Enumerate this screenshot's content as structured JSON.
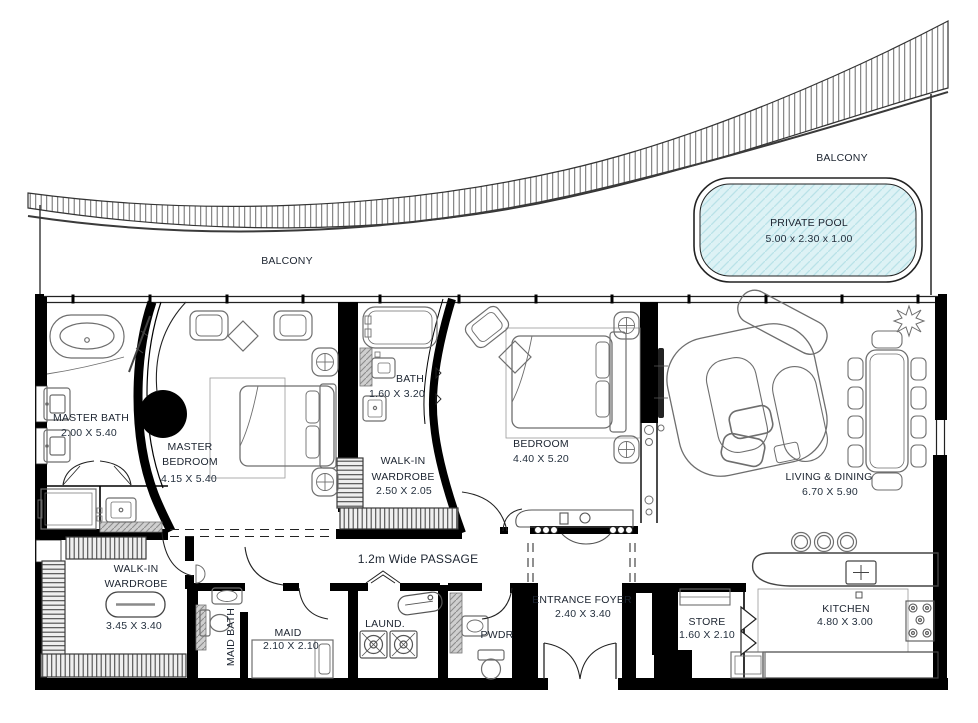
{
  "balcony": {
    "label_left": "BALCONY",
    "label_right": "BALCONY"
  },
  "pool": {
    "name": "PRIVATE POOL",
    "dims": "5.00 x 2.30 x 1.00"
  },
  "rooms": {
    "master_bath": {
      "name": "MASTER BATH",
      "dims": "2.00 X 5.40"
    },
    "master_bedroom": {
      "line1": "MASTER",
      "line2": "BEDROOM",
      "dims": "4.15 X 5.40"
    },
    "bath": {
      "name": "BATH",
      "dims": "1.60 X 3.20"
    },
    "walkin_wardrobe_small": {
      "line1": "WALK-IN",
      "line2": "WARDROBE",
      "dims": "2.50 X 2.05"
    },
    "bedroom": {
      "name": "BEDROOM",
      "dims": "4.40 X 5.20"
    },
    "living_dining": {
      "name": "LIVING & DINING",
      "dims": "6.70 X 5.90"
    },
    "walkin_wardrobe_large": {
      "line1": "WALK-IN",
      "line2": "WARDROBE",
      "dims": "3.45 X 3.40"
    },
    "maid_bath": {
      "name": "MAID BATH"
    },
    "maid": {
      "name": "MAID",
      "dims": "2.10 X 2.10"
    },
    "laundry": {
      "name": "LAUND."
    },
    "powder": {
      "name": "PWDR"
    },
    "passage": {
      "name": "1.2m Wide PASSAGE"
    },
    "entrance_foyer": {
      "name": "ENTRANCE FOYER",
      "dims": "2.40 X 3.40"
    },
    "store": {
      "name": "STORE",
      "dims": "1.60 X 2.10"
    },
    "kitchen": {
      "name": "KITCHEN",
      "dims": "4.80 X 3.00"
    }
  },
  "colors": {
    "wall": "#000000",
    "furniture_line": "#6e6e6e",
    "pool_fill": "#ddf2f5",
    "pool_hatch": "#b9e2e8",
    "text": "#1c2430"
  }
}
